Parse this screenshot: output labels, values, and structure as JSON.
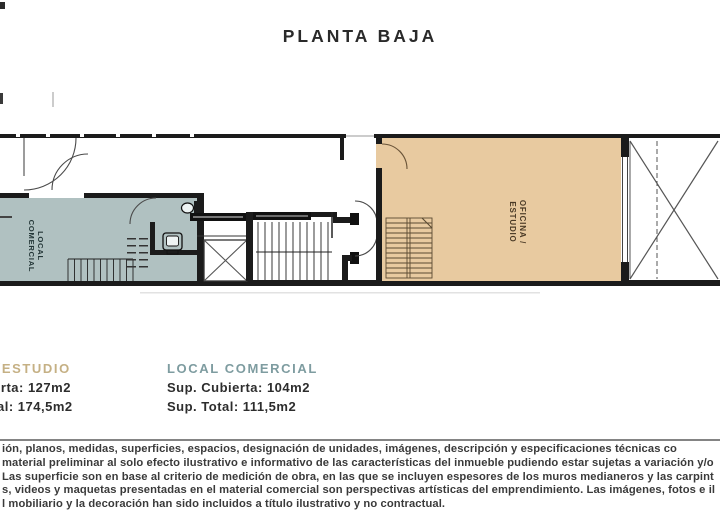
{
  "title": "PLANTA BAJA",
  "plan": {
    "wall_color": "#1b1b1b",
    "rooms": {
      "local_comercial": {
        "label_line1": "LOCAL",
        "label_line2": "COMERCIAL",
        "fill": "#b0c1c1",
        "text_color": "#233637"
      },
      "oficina_estudio": {
        "label_line1": "OFICINA /",
        "label_line2": "ESTUDIO",
        "fill": "#e8caa0",
        "text_color": "#4a3a26"
      }
    }
  },
  "legend": {
    "left": {
      "title": "OFICINA/ESTUDIO",
      "title_color": "#c5b084",
      "line1": "Sup. Cubierta: 127m2",
      "line2": "Sup. Total: 174,5m2"
    },
    "right": {
      "title": "LOCAL COMERCIAL",
      "title_color": "#7e9ca0",
      "line1": "Sup. Cubierta: 104m2",
      "line2": "Sup. Total: 111,5m2"
    }
  },
  "disclaimer": {
    "line1": "ión, planos, medidas, superficies, espacios, designación de unidades, imágenes, descripción y especificaciones técnicas co",
    "line2": "material preliminar al solo efecto ilustrativo e informativo de las características del inmueble pudiendo estar sujetas a variación y/o",
    "line3": "Las superficie son en base al criterio de medición de obra, en las que se incluyen espesores de los muros medianeros y las carpint",
    "line4": "s, videos y maquetas presentadas en el material comercial son perspectivas artísticas del emprendimiento. Las imágenes, fotos e il",
    "line5": "l mobiliario y la decoración han sido incluidos a título ilustrativo y no contractual."
  }
}
